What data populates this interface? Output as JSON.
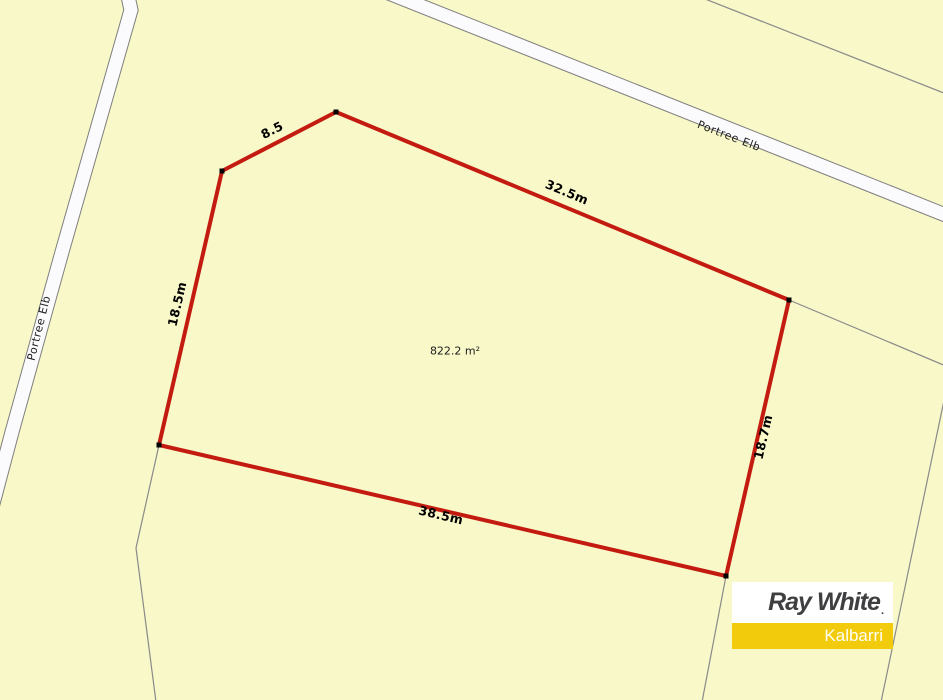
{
  "map": {
    "description": "Cadastral land-lot map",
    "area_label": "822.2 m²",
    "dimensions": {
      "top_left_edge": "8.5",
      "top_edge": "32.5m",
      "left_edge": "18.5m",
      "right_edge": "18.7m",
      "bottom_edge": "38.5m"
    },
    "road_labels": {
      "left_road": "Portree Elb",
      "top_road": "Portree Elb"
    }
  },
  "logo": {
    "brand": "Ray White",
    "trademark": ".",
    "office": "Kalbarri"
  },
  "colors": {
    "background": "#F8F8C9",
    "lot_boundary": "#C41B10",
    "road_fill": "#FBFBFE",
    "road_casing": "#7E7E7E",
    "cadastral_line": "#8A8A8A",
    "logo_yellow": "#F2CC0C",
    "logo_text": "#3F3F41"
  }
}
